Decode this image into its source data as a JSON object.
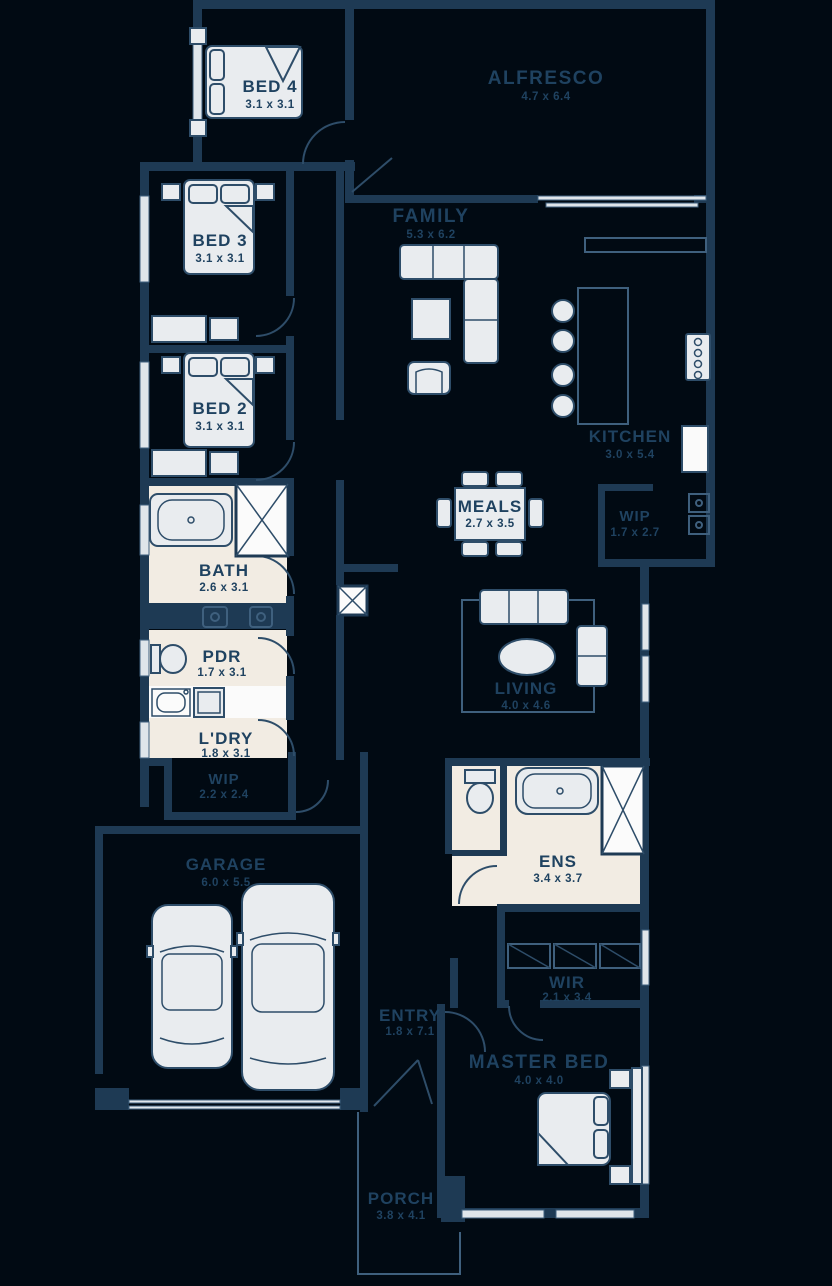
{
  "plan": {
    "type": "residential-floor-plan",
    "colors": {
      "background": "#010a13",
      "wall": "#1e3a54",
      "label_text": "#1f4260",
      "furniture_fill": "#e9ecef",
      "wet_area_floor": "#f2ece3",
      "shower_white": "#fbfbfb"
    },
    "rooms": {
      "bed4": {
        "label": "BED 4",
        "dims": "3.1 x 3.1"
      },
      "alfresco": {
        "label": "ALFRESCO",
        "dims": "4.7 x 6.4"
      },
      "bed3": {
        "label": "BED 3",
        "dims": "3.1 x 3.1"
      },
      "family": {
        "label": "FAMILY",
        "dims": "5.3 x 6.2"
      },
      "bed2": {
        "label": "BED 2",
        "dims": "3.1 x 3.1"
      },
      "kitchen": {
        "label": "KITCHEN",
        "dims": "3.0 x 5.4"
      },
      "meals": {
        "label": "MEALS",
        "dims": "2.7 x 3.5"
      },
      "wip_kitchen": {
        "label": "WIP",
        "dims": "1.7 x 2.7"
      },
      "bath": {
        "label": "BATH",
        "dims": "2.6 x 3.1"
      },
      "pdr": {
        "label": "PDR",
        "dims": "1.7 x 3.1"
      },
      "ldry": {
        "label": "L'DRY",
        "dims": "1.8 x 3.1"
      },
      "wip_laundry": {
        "label": "WIP",
        "dims": "2.2 x 2.4"
      },
      "living": {
        "label": "LIVING",
        "dims": "4.0 x 4.6"
      },
      "garage": {
        "label": "GARAGE",
        "dims": "6.0 x 5.5"
      },
      "ens": {
        "label": "ENS",
        "dims": "3.4 x 3.7"
      },
      "wir": {
        "label": "WIR",
        "dims": "2.1 x 3.4"
      },
      "entry": {
        "label": "ENTRY",
        "dims": "1.8 x 7.1"
      },
      "master_bed": {
        "label": "MASTER BED",
        "dims": "4.0 x 4.0"
      },
      "porch": {
        "label": "PORCH",
        "dims": "3.8 x 4.1"
      }
    }
  }
}
